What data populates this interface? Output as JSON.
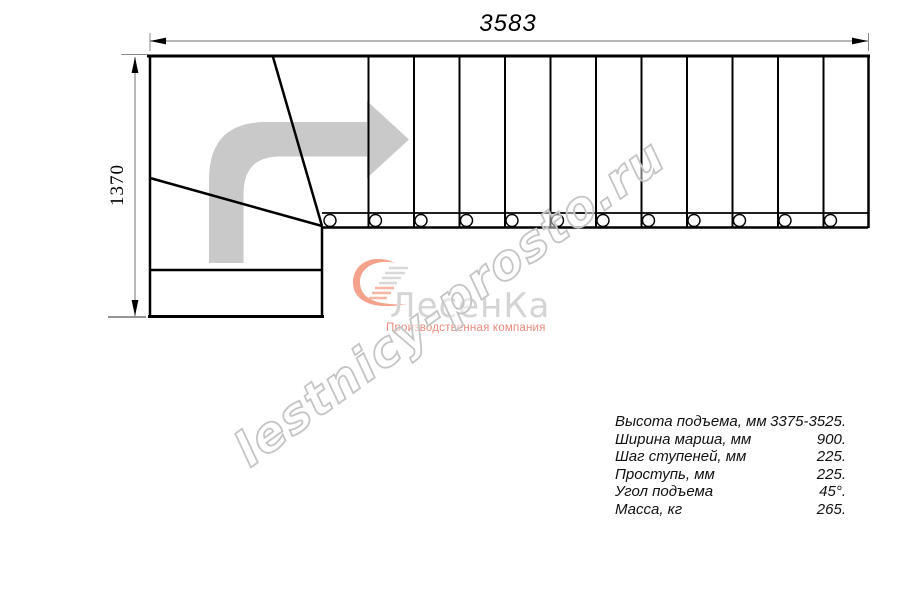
{
  "drawing": {
    "top_dimension": "3583",
    "left_dimension": "1370",
    "description": "plan view of L-shaped staircase with winder treads and straight flight of 12 steps"
  },
  "watermark": {
    "text": "lestnicy-prosto.ru"
  },
  "logo": {
    "name": "ЛесенКа",
    "tagline": "Производственная компания",
    "brand_color": "#f4a28c",
    "text_color": "#d4d4d4"
  },
  "specs": {
    "rows": [
      {
        "label": "Высота подъема, мм",
        "value": "3375-3525."
      },
      {
        "label": "Ширина марша, мм",
        "value": "900."
      },
      {
        "label": "Шаг ступеней, мм",
        "value": "225."
      },
      {
        "label": "Проступь, мм",
        "value": "225."
      },
      {
        "label": "Угол подъема",
        "value": "45°."
      },
      {
        "label": "Масса, кг",
        "value": "265."
      }
    ]
  },
  "colors": {
    "line": "#000000",
    "dimension_line": "#8a8a8a",
    "direction_arrow": "#c9c9c9",
    "watermark_outline": "#c5c5c5"
  }
}
